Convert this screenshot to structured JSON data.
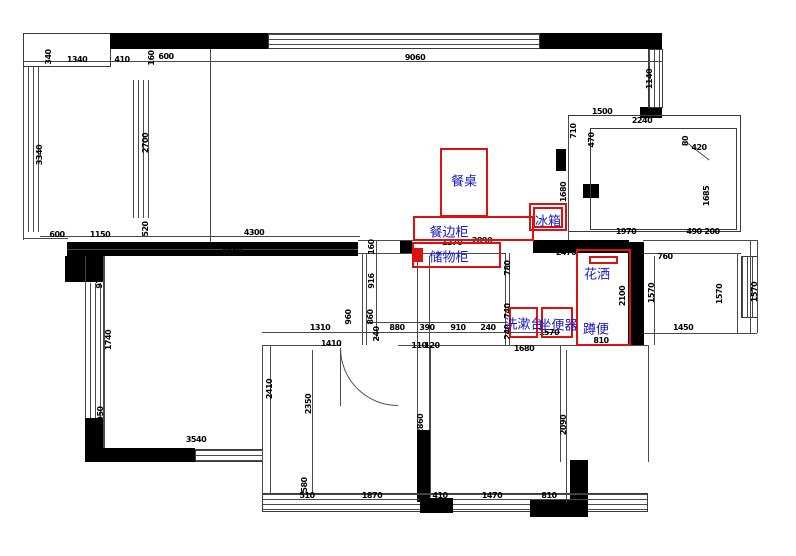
{
  "drawing": {
    "kind": "apartment-floor-plan",
    "units": "mm"
  },
  "colors": {
    "wall": "#000000",
    "outline": "#4a4a4a",
    "dimension_text": "#000000",
    "annotation_box": "#dd1111",
    "annotation_label": "#1616c8"
  },
  "annotations": {
    "boxes": [
      {
        "name": "dining-table-box",
        "rect": [
          440,
          148,
          48,
          69
        ],
        "filled": false
      },
      {
        "name": "sideboard-box",
        "rect": [
          413,
          216,
          121,
          25
        ],
        "filled": false
      },
      {
        "name": "fridge-box-outer",
        "rect": [
          529,
          203,
          38,
          28
        ],
        "filled": false
      },
      {
        "name": "fridge-box-inner",
        "rect": [
          533,
          207,
          30,
          21
        ],
        "filled": false
      },
      {
        "name": "storage-cabinet-box",
        "rect": [
          412,
          242,
          89,
          26
        ],
        "filled": false
      },
      {
        "name": "storage-cabinet-marker",
        "rect": [
          414,
          248,
          9,
          14
        ],
        "filled": true
      },
      {
        "name": "washstand-box",
        "rect": [
          509,
          307,
          29,
          31
        ],
        "filled": false
      },
      {
        "name": "toilet-box",
        "rect": [
          541,
          307,
          32,
          31
        ],
        "filled": false
      },
      {
        "name": "shower-area-box",
        "rect": [
          576,
          249,
          55,
          97
        ],
        "filled": false
      },
      {
        "name": "shower-head-box",
        "rect": [
          589,
          256,
          29,
          8
        ],
        "filled": false
      }
    ],
    "labels": [
      {
        "name": "dining-table-label",
        "text": "餐桌",
        "x": 464,
        "y": 182
      },
      {
        "name": "sideboard-label",
        "text": "餐边柜",
        "x": 449,
        "y": 233
      },
      {
        "name": "fridge-label",
        "text": "冰箱",
        "x": 548,
        "y": 222
      },
      {
        "name": "storage-cabinet-label",
        "text": "储物柜",
        "x": 449,
        "y": 258
      },
      {
        "name": "washstand-label",
        "text": "洗漱台",
        "x": 524,
        "y": 325
      },
      {
        "name": "toilet-label",
        "text": "坐便器",
        "x": 558,
        "y": 326
      },
      {
        "name": "shower-label",
        "text": "花洒",
        "x": 597,
        "y": 275
      },
      {
        "name": "squat-toilet-label",
        "text": "蹲便",
        "x": 596,
        "y": 330
      }
    ]
  },
  "dimensions": [
    {
      "text": "1340",
      "x": 77,
      "y": 60,
      "v": false
    },
    {
      "text": "410",
      "x": 122,
      "y": 60,
      "v": false
    },
    {
      "text": "160",
      "x": 152,
      "y": 58,
      "v": true
    },
    {
      "text": "600",
      "x": 166,
      "y": 57,
      "v": false
    },
    {
      "text": "9060",
      "x": 415,
      "y": 58,
      "v": false
    },
    {
      "text": "1500",
      "x": 602,
      "y": 112,
      "v": false
    },
    {
      "text": "2240",
      "x": 642,
      "y": 121,
      "v": false
    },
    {
      "text": "420",
      "x": 699,
      "y": 148,
      "v": false
    },
    {
      "text": "600",
      "x": 57,
      "y": 235,
      "v": false
    },
    {
      "text": "1150",
      "x": 100,
      "y": 235,
      "v": false
    },
    {
      "text": "4300",
      "x": 254,
      "y": 233,
      "v": false
    },
    {
      "text": "4850",
      "x": 232,
      "y": 251,
      "v": false
    },
    {
      "text": "2890",
      "x": 482,
      "y": 241,
      "v": false
    },
    {
      "text": "1270",
      "x": 452,
      "y": 243,
      "v": false
    },
    {
      "text": "2470",
      "x": 566,
      "y": 253,
      "v": false
    },
    {
      "text": "1970",
      "x": 626,
      "y": 232,
      "v": false
    },
    {
      "text": "490",
      "x": 694,
      "y": 232,
      "v": false
    },
    {
      "text": "200",
      "x": 712,
      "y": 232,
      "v": false
    },
    {
      "text": "760",
      "x": 665,
      "y": 257,
      "v": false
    },
    {
      "text": "1310",
      "x": 320,
      "y": 328,
      "v": false
    },
    {
      "text": "880",
      "x": 397,
      "y": 328,
      "v": false
    },
    {
      "text": "390",
      "x": 427,
      "y": 328,
      "v": false
    },
    {
      "text": "910",
      "x": 458,
      "y": 328,
      "v": false
    },
    {
      "text": "240",
      "x": 488,
      "y": 328,
      "v": false
    },
    {
      "text": "1410",
      "x": 331,
      "y": 344,
      "v": false
    },
    {
      "text": "110",
      "x": 419,
      "y": 346,
      "v": false
    },
    {
      "text": "120",
      "x": 432,
      "y": 346,
      "v": false
    },
    {
      "text": "1570",
      "x": 549,
      "y": 333,
      "v": false
    },
    {
      "text": "1680",
      "x": 524,
      "y": 349,
      "v": false
    },
    {
      "text": "810",
      "x": 601,
      "y": 341,
      "v": false
    },
    {
      "text": "1450",
      "x": 683,
      "y": 328,
      "v": false
    },
    {
      "text": "3540",
      "x": 196,
      "y": 440,
      "v": false
    },
    {
      "text": "510",
      "x": 307,
      "y": 496,
      "v": false
    },
    {
      "text": "1870",
      "x": 372,
      "y": 496,
      "v": false
    },
    {
      "text": "410",
      "x": 440,
      "y": 496,
      "v": false
    },
    {
      "text": "1470",
      "x": 492,
      "y": 496,
      "v": false
    },
    {
      "text": "810",
      "x": 549,
      "y": 496,
      "v": false
    },
    {
      "text": "340",
      "x": 49,
      "y": 57,
      "v": true
    },
    {
      "text": "3340",
      "x": 40,
      "y": 155,
      "v": true
    },
    {
      "text": "2700",
      "x": 146,
      "y": 143,
      "v": true
    },
    {
      "text": "1140",
      "x": 650,
      "y": 79,
      "v": true
    },
    {
      "text": "710",
      "x": 574,
      "y": 131,
      "v": true
    },
    {
      "text": "470",
      "x": 592,
      "y": 140,
      "v": true
    },
    {
      "text": "80",
      "x": 686,
      "y": 141,
      "v": true
    },
    {
      "text": "1685",
      "x": 707,
      "y": 196,
      "v": true
    },
    {
      "text": "1680",
      "x": 564,
      "y": 192,
      "v": true
    },
    {
      "text": "520",
      "x": 146,
      "y": 229,
      "v": true
    },
    {
      "text": "970",
      "x": 100,
      "y": 281,
      "v": true
    },
    {
      "text": "1740",
      "x": 109,
      "y": 340,
      "v": true
    },
    {
      "text": "950",
      "x": 101,
      "y": 414,
      "v": true
    },
    {
      "text": "160",
      "x": 372,
      "y": 247,
      "v": true
    },
    {
      "text": "916",
      "x": 372,
      "y": 281,
      "v": true
    },
    {
      "text": "960",
      "x": 349,
      "y": 317,
      "v": true
    },
    {
      "text": "860",
      "x": 371,
      "y": 317,
      "v": true
    },
    {
      "text": "240",
      "x": 377,
      "y": 334,
      "v": true
    },
    {
      "text": "780",
      "x": 508,
      "y": 268,
      "v": true
    },
    {
      "text": "740",
      "x": 508,
      "y": 311,
      "v": true
    },
    {
      "text": "240",
      "x": 508,
      "y": 332,
      "v": true
    },
    {
      "text": "2100",
      "x": 623,
      "y": 296,
      "v": true
    },
    {
      "text": "1570",
      "x": 652,
      "y": 293,
      "v": true
    },
    {
      "text": "1570",
      "x": 720,
      "y": 294,
      "v": true
    },
    {
      "text": "1570",
      "x": 755,
      "y": 292,
      "v": true
    },
    {
      "text": "2410",
      "x": 270,
      "y": 389,
      "v": true
    },
    {
      "text": "2350",
      "x": 309,
      "y": 404,
      "v": true
    },
    {
      "text": "2860",
      "x": 421,
      "y": 424,
      "v": true
    },
    {
      "text": "2090",
      "x": 564,
      "y": 425,
      "v": true
    },
    {
      "text": "580",
      "x": 305,
      "y": 485,
      "v": true
    }
  ]
}
